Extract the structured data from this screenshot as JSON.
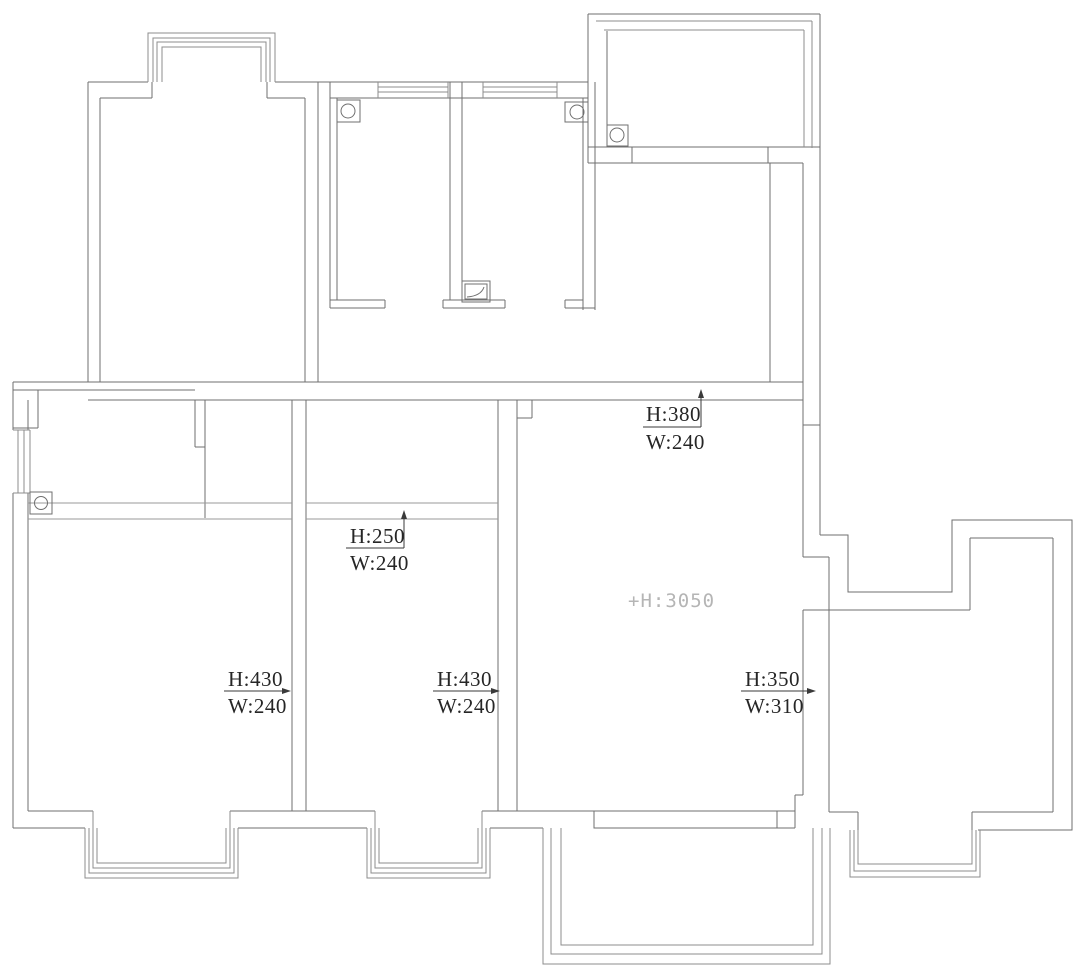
{
  "document": {
    "type": "architectural-floor-plan",
    "background": "#ffffff"
  },
  "colors": {
    "wall_line": "#6f6f6f",
    "window_line": "#8c8c8c",
    "beam_line": "#9a9a9a",
    "fixture_line": "#6f6f6f",
    "annotation_line": "#3a3a3a",
    "annotation_text": "#262626",
    "ceiling_label_text": "#b5b5b5"
  },
  "annotations": {
    "beam_380": {
      "height": "H:380",
      "width": "W:240"
    },
    "beam_250": {
      "height": "H:250",
      "width": "W:240"
    },
    "wall_430_left": {
      "height": "H:430",
      "width": "W:240"
    },
    "wall_430_center": {
      "height": "H:430",
      "width": "W:240"
    },
    "wall_350_right": {
      "height": "H:350",
      "width": "W:310"
    },
    "ceiling_height": "+H:3050"
  }
}
